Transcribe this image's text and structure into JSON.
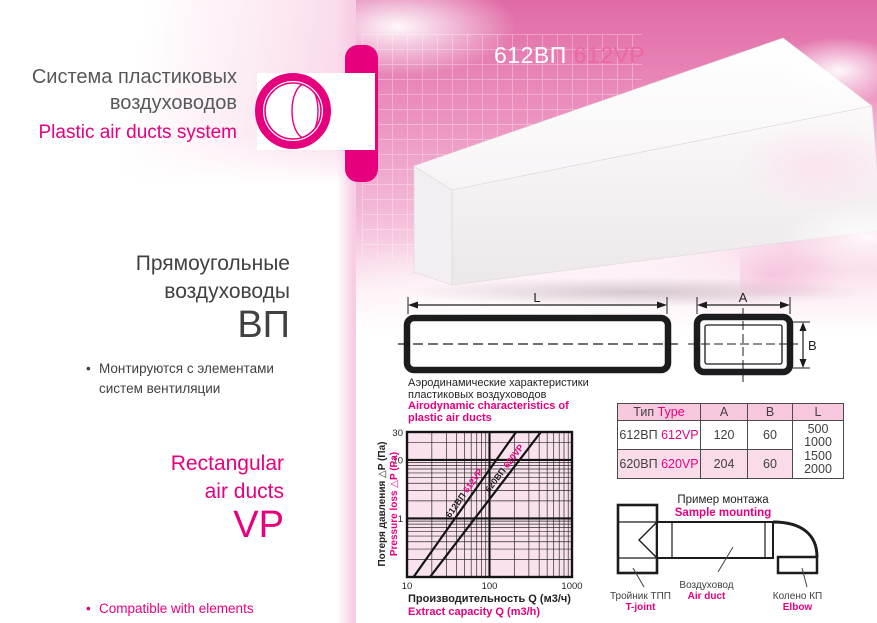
{
  "colors": {
    "magenta": "#e6007e",
    "dark": "#414042",
    "grid_major": "#141414",
    "grid_minor": "#2b2b2b",
    "plot_bg": "#f9e2ee"
  },
  "header": {
    "title_ru_1": "Система пластиковых",
    "title_ru_2": "воздуховодов",
    "title_en": "Plastic air ducts system"
  },
  "product": {
    "code_ru": "612ВП",
    "code_en": "612VP"
  },
  "left": {
    "heading_ru_1": "Прямоугольные",
    "heading_ru_2": "воздуховоды",
    "code_ru": "ВП",
    "bullet_ru_1": "Монтируются с элементами",
    "bullet_ru_2": "систем вентиляции",
    "heading_en_1": "Rectangular",
    "heading_en_2": "air ducts",
    "code_en": "VP",
    "bullet_en_1": "Compatible with elements",
    "bullet_en_2": "of ventilation system",
    "bullet_glyph": "•"
  },
  "drawing": {
    "dim_l": "L",
    "dim_a": "A",
    "dim_b": "B"
  },
  "chart": {
    "title_ru_1": "Аэродинамические характеристики",
    "title_ru_2": "пластиковых воздуховодов",
    "title_en_1": "Airodynamic characteristics of",
    "title_en_2": "plastic air ducts",
    "ylabel_ru": "Потеря давления △P (Па)",
    "ylabel_en": "Pressure loss △P (Pa)",
    "xlabel_ru": "Производительность Q (м3/ч)",
    "xlabel_en": "Extract capacity Q (m3/h)"
  },
  "chart_data": {
    "type": "line",
    "x_scale": "log",
    "y_scale": "log",
    "xlim": [
      10,
      1000
    ],
    "ylim": [
      0.1,
      30
    ],
    "x_ticks": [
      10,
      100,
      1000
    ],
    "y_ticks": [
      30,
      10,
      1
    ],
    "grid": "log-log, minor decade lines",
    "title": "Аэродинамические характеристики пластиковых воздуховодов / Airodynamic characteristics of plastic air ducts",
    "xlabel": "Производительность Q (м3/ч) / Extract capacity Q (m3/h)",
    "ylabel": "Потеря давления ΔP (Па) / Pressure loss ΔP (Pa)",
    "series": [
      {
        "name_ru": "612ВП",
        "name_en": "612VP",
        "points": [
          [
            12,
            0.1
          ],
          [
            210,
            30
          ]
        ]
      },
      {
        "name_ru": "620ВП",
        "name_en": "620VP",
        "points": [
          [
            19,
            0.1
          ],
          [
            420,
            30
          ]
        ]
      }
    ]
  },
  "table": {
    "header": {
      "type_ru": "Тип",
      "type_en": "Type",
      "a": "A",
      "b": "B",
      "l": "L"
    },
    "rows": [
      {
        "ru": "612ВП",
        "en": "612VP",
        "a": "120",
        "b": "60"
      },
      {
        "ru": "620ВП",
        "en": "620VP",
        "a": "204",
        "b": "60"
      }
    ],
    "l_values": [
      "500",
      "1000",
      "1500",
      "2000"
    ]
  },
  "mounting": {
    "title_ru": "Пример монтажа",
    "title_en": "Sample mounting",
    "labels": [
      {
        "ru": "Тройник ТПП",
        "en": "T-joint"
      },
      {
        "ru": "Воздуховод",
        "en": "Air duct"
      },
      {
        "ru": "Колено КП",
        "en": "Elbow"
      }
    ]
  }
}
